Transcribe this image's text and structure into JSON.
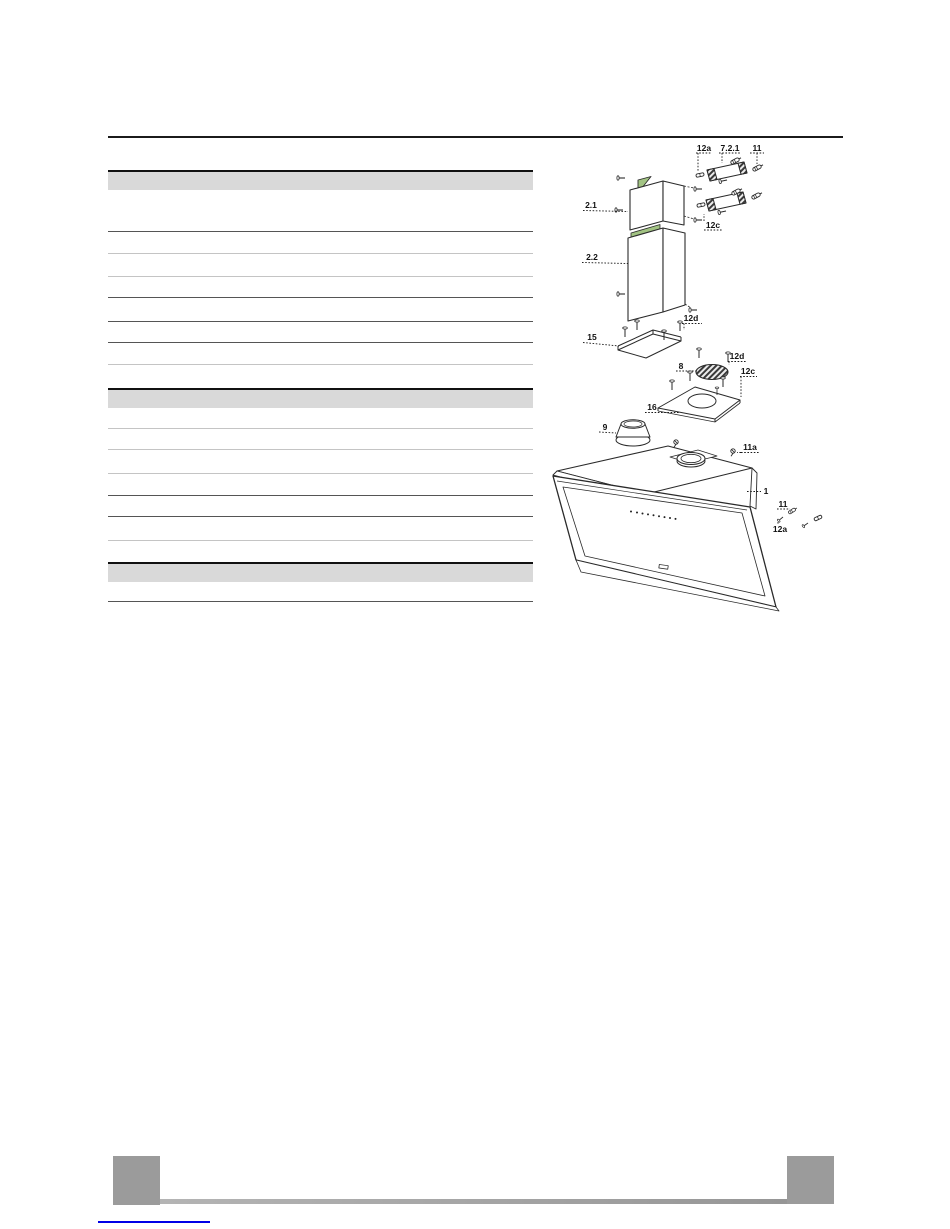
{
  "page": {
    "background": "#ffffff"
  },
  "colors": {
    "rule_black": "#1b1b1b",
    "table_header_bg": "#d9d9d9",
    "row_line_dark": "#555555",
    "row_line_light": "#c4c4c4",
    "diagram_stroke": "#2a2a2a",
    "accent_green": "#a2c383",
    "footer_gray": "#9b9b9b",
    "link_blue": "#0000e6"
  },
  "parts_table": {
    "sections": [
      {
        "header_label": "",
        "row_count": 8,
        "rows": [
          "",
          "",
          "",
          "",
          "",
          "",
          "",
          ""
        ]
      },
      {
        "header_label": "",
        "row_count": 7,
        "rows": [
          "",
          "",
          "",
          "",
          "",
          "",
          ""
        ]
      },
      {
        "header_label": "",
        "row_count": 1,
        "rows": [
          ""
        ]
      }
    ]
  },
  "diagram": {
    "type": "exploded-view-cooker-hood",
    "labels": [
      {
        "text": "12a"
      },
      {
        "text": "7.2.1"
      },
      {
        "text": "11"
      },
      {
        "text": "2.1"
      },
      {
        "text": "12c"
      },
      {
        "text": "2.2"
      },
      {
        "text": "12d"
      },
      {
        "text": "15"
      },
      {
        "text": "8"
      },
      {
        "text": "12d"
      },
      {
        "text": "12c"
      },
      {
        "text": "16"
      },
      {
        "text": "9"
      },
      {
        "text": "11a"
      },
      {
        "text": "1"
      },
      {
        "text": "11"
      },
      {
        "text": "12a"
      }
    ]
  },
  "footer": {
    "left_box_label": "",
    "right_box_label": "",
    "link_text": ""
  }
}
